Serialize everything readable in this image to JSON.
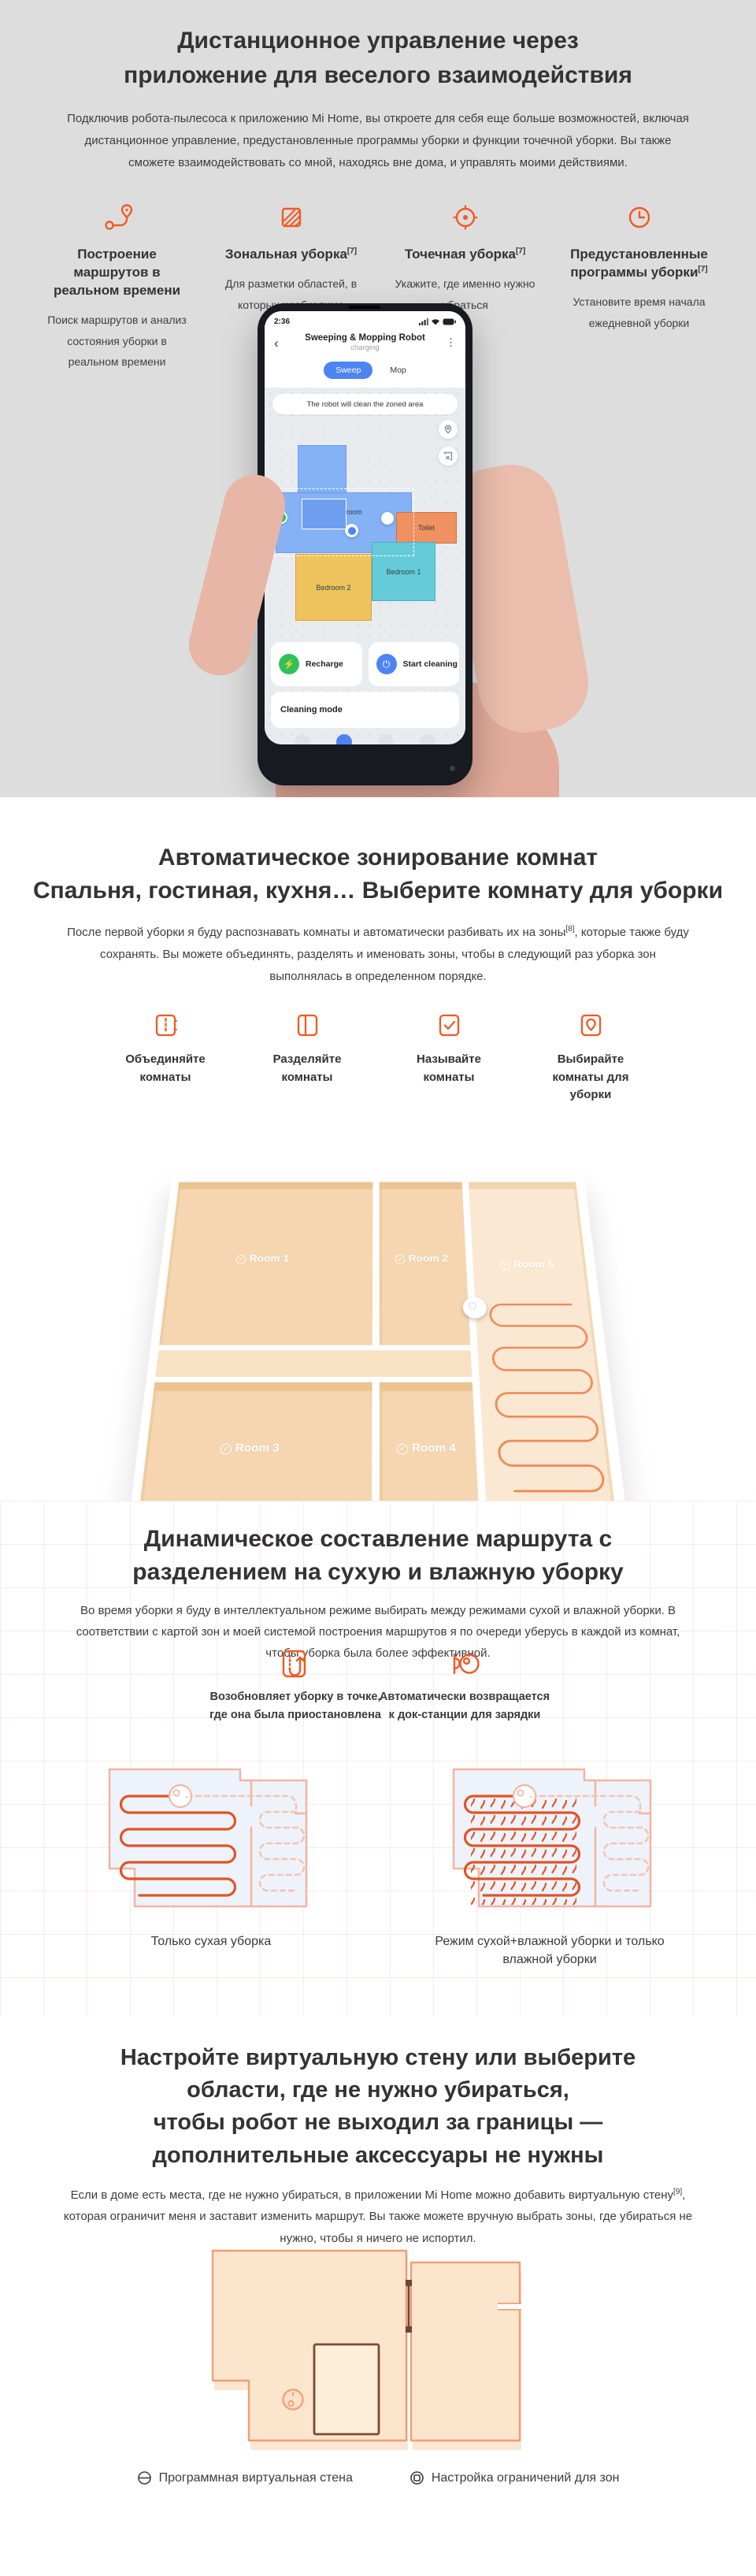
{
  "accent_color": "#f05a23",
  "section1": {
    "title_line1": "Дистанционное управление через",
    "title_line2": "приложение для веселого взаимодействия",
    "description": "Подключив робота-пылесоса к приложению Mi Home, вы откроете для себя еще больше возможностей, включая дистанционное управление, предустановленные программы уборки и функции точечной уборки. Вы также сможете взаимодействовать со мной, находясь вне дома, и управлять моими действиями.",
    "features": [
      {
        "icon": "route-icon",
        "title": "Построение маршрутов в реальном времени",
        "sup": "",
        "text": "Поиск маршрутов и анализ состояния уборки в реальном времени"
      },
      {
        "icon": "zone-icon",
        "title": "Зональная уборка",
        "sup": "[7]",
        "text": "Для разметки областей, в которых необходимо убраться"
      },
      {
        "icon": "spot-icon",
        "title": "Точечная уборка",
        "sup": "[7]",
        "text": "Укажите, где именно нужно убраться"
      },
      {
        "icon": "clock-icon",
        "title": "Предустановленные программы уборки",
        "sup": "[7]",
        "text": "Установите время начала ежедневной уборки"
      }
    ],
    "phone": {
      "time": "2:36",
      "app_title": "Sweeping & Mopping Robot",
      "app_status": "charging",
      "tab_sweep": "Sweep",
      "tab_mop": "Mop",
      "banner": "The robot will clean the zoned area",
      "rooms": [
        {
          "name": "Living room",
          "color": "#84b2f5"
        },
        {
          "name": "Toilet",
          "color": "#ef9160"
        },
        {
          "name": "Bedroom 1",
          "color": "#66cbd8"
        },
        {
          "name": "Bedroom 2",
          "color": "#eec25c"
        }
      ],
      "recharge_label": "Recharge",
      "start_label": "Start cleaning",
      "mode_label": "Cleaning mode"
    }
  },
  "section2": {
    "title_line1": "Автоматическое зонирование комнат",
    "title_line2": "Спальня, гостиная, кухня… Выберите комнату для уборки",
    "desc_part1": "После первой уборки я буду распознавать комнаты и автоматически разбивать их на зоны",
    "desc_sup": "[8]",
    "desc_part2": ", которые также буду сохранять. Вы можете объединять, разделять и именовать зоны, чтобы в следующий раз уборка зон выполнялась в определенном порядке.",
    "actions": [
      {
        "icon": "merge-rooms-icon",
        "label": "Объединяйте комнаты"
      },
      {
        "icon": "split-rooms-icon",
        "label": "Разделяйте комнаты"
      },
      {
        "icon": "name-rooms-icon",
        "label": "Называйте комнаты"
      },
      {
        "icon": "select-rooms-icon",
        "label": "Выбирайте комнаты для уборки"
      }
    ],
    "plan_rooms": [
      "Room 1",
      "Room 2",
      "Room 5",
      "Room 3",
      "Room 4"
    ]
  },
  "section3": {
    "title_line1": "Динамическое составление маршрута с",
    "title_line2": "разделением на сухую и влажную уборку",
    "description": "Во время уборки я буду в интеллектуальном режиме выбирать между режимами сухой и влажной уборки. В соответствии с картой зон и моей системой построения маршрутов я по очереди уберусь в каждой из комнат, чтобы уборка была более эффективной.",
    "callouts": [
      {
        "icon": "resume-icon",
        "text": "Возобновляет уборку в точке, где она была приостановлена"
      },
      {
        "icon": "dock-return-icon",
        "text": "Автоматически возвращается к док-станции для зарядки"
      }
    ],
    "captions": [
      "Только сухая уборка",
      "Режим сухой+влажной уборки и только влажной уборки"
    ]
  },
  "section4": {
    "title_line1": "Настройте виртуальную стену или выберите",
    "title_line2": "области, где не нужно убираться,",
    "title_line3": "чтобы робот не выходил за границы —",
    "title_line4": "дополнительные аксессуары не нужны",
    "desc_part1": "Если в доме есть места, где не нужно убираться, в приложении Mi Home можно добавить виртуальную стену",
    "desc_sup": "[9]",
    "desc_part2": ", которая ограничит меня и заставит изменить маршрут. Вы также можете вручную выбрать зоны, где убираться не нужно, чтобы я ничего не испортил.",
    "legend": [
      {
        "icon": "virtual-wall-icon",
        "label": "Программная виртуальная стена"
      },
      {
        "icon": "zone-restriction-icon",
        "label": "Настройка ограничений для зон"
      }
    ]
  }
}
